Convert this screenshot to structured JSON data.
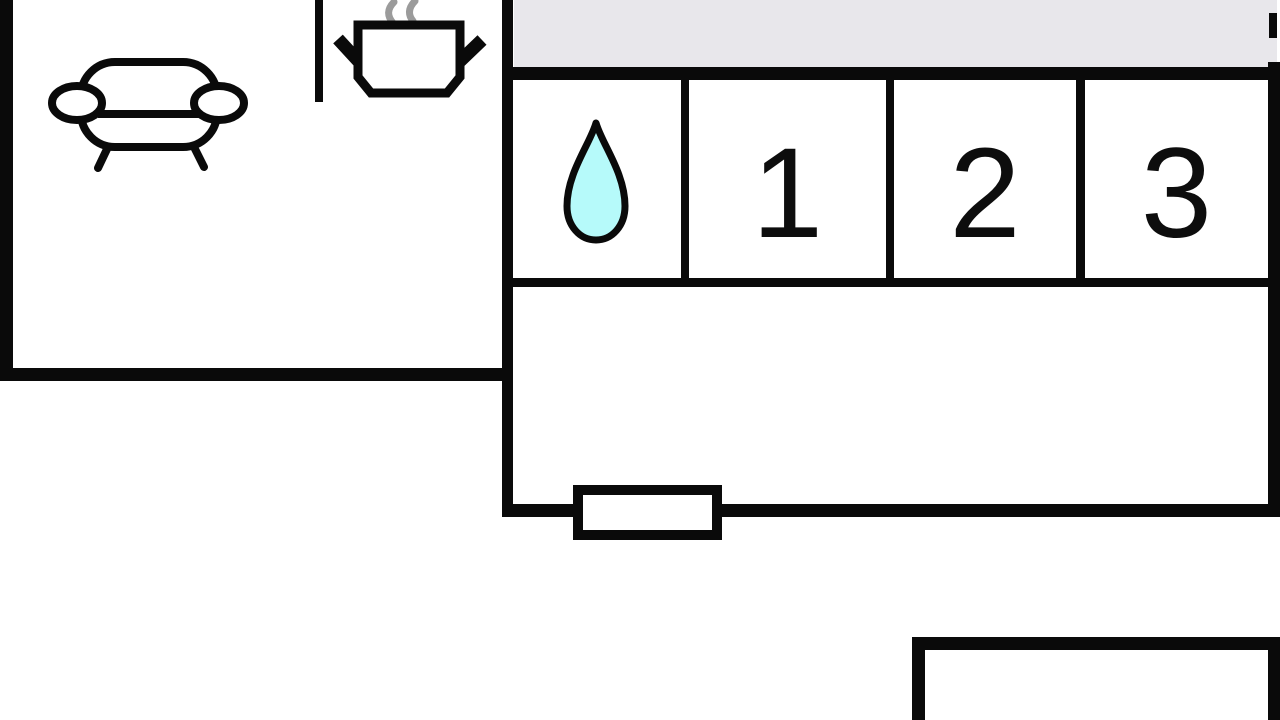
{
  "plan": {
    "rooms": [
      {
        "name": "living-room",
        "label": ""
      },
      {
        "name": "kitchen",
        "label": ""
      },
      {
        "name": "bathroom",
        "label": "",
        "icon": "water-drop-icon"
      },
      {
        "name": "bedroom-1",
        "label": "1"
      },
      {
        "name": "bedroom-2",
        "label": "2"
      },
      {
        "name": "bedroom-3",
        "label": "3"
      },
      {
        "name": "hallway",
        "label": ""
      },
      {
        "name": "terrace",
        "label": ""
      },
      {
        "name": "room-below",
        "label": ""
      }
    ],
    "icons": {
      "living_room_icon": "sofa-icon",
      "kitchen_icon": "cooking-pot-icon",
      "bathroom_icon": "water-drop-icon",
      "window_icon": "window-marker"
    },
    "colors": {
      "background": "#ffffff",
      "wall": "#0a0a0a",
      "terrace_fill": "#e8e7eb",
      "water_drop_fill": "#b6fafa",
      "steam": "#9b9b9b",
      "room_number": "#0d0d0d"
    }
  }
}
